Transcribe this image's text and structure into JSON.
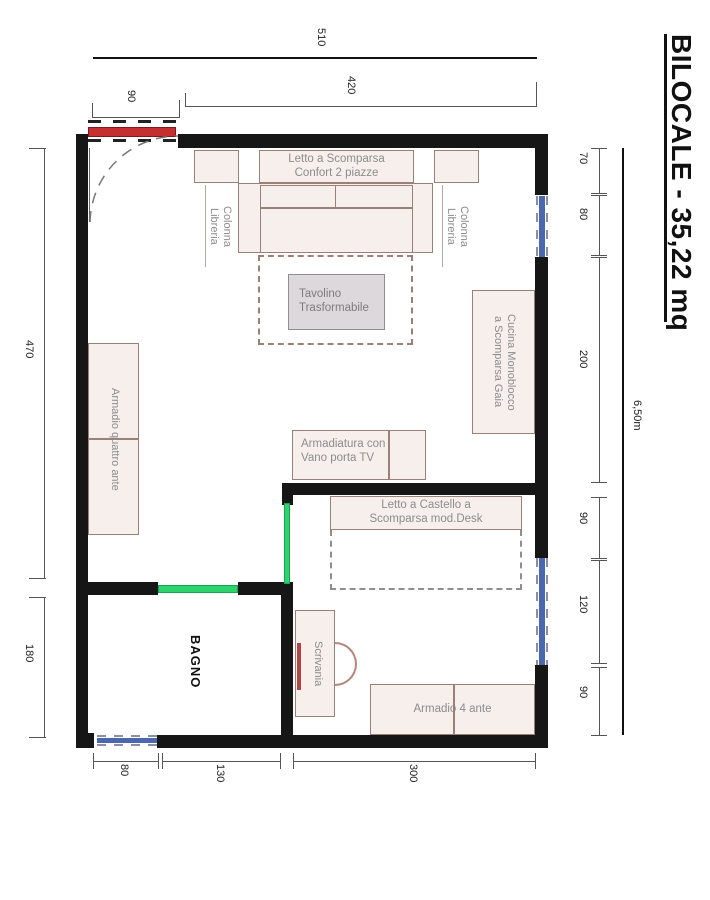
{
  "title": "BILOCALE - 35,22 mq",
  "dimensions": {
    "top": {
      "overall": "510",
      "inner": "420",
      "entry": "90"
    },
    "right": {
      "segments": [
        "70",
        "80",
        "200",
        "90",
        "120",
        "90"
      ],
      "overall": "6,50m"
    },
    "left": {
      "segments": [
        "470",
        "180"
      ]
    },
    "bottom": {
      "segments": [
        "80",
        "130",
        "300"
      ]
    }
  },
  "rooms": {
    "bathroom": "BAGNO"
  },
  "furniture": {
    "fold_away_bed": "Letto a Scomparsa\nConfort 2 piazze",
    "bookcase_left": "Colonna\nLibreria",
    "bookcase_right": "Colonna\nLibreria",
    "coffee_table": "Tavolino\nTrasformabile",
    "kitchen": "Cucina Monoblocco\na Scomparsa Gaia",
    "wardrobe_four_door": "Armadio quattro ante",
    "tv_cabinet": "Armadiatura con\nVano porta TV",
    "bunk_bed": "Letto a Castello a\nScomparsa mod.Desk",
    "desk": "Scrivania",
    "wardrobe_4_ante": "Armadio 4 ante"
  },
  "colors": {
    "wall": "#161616",
    "furniture_fill": "#f7efec",
    "furniture_border": "#9b8078",
    "table_fill": "#dcd8dc",
    "door_red": "#c52f2f",
    "partition_green": "#2fd36e",
    "window_blue": "#4a67b0",
    "label_gray": "#8c8c8c",
    "desk_accent_red": "#b24444"
  }
}
